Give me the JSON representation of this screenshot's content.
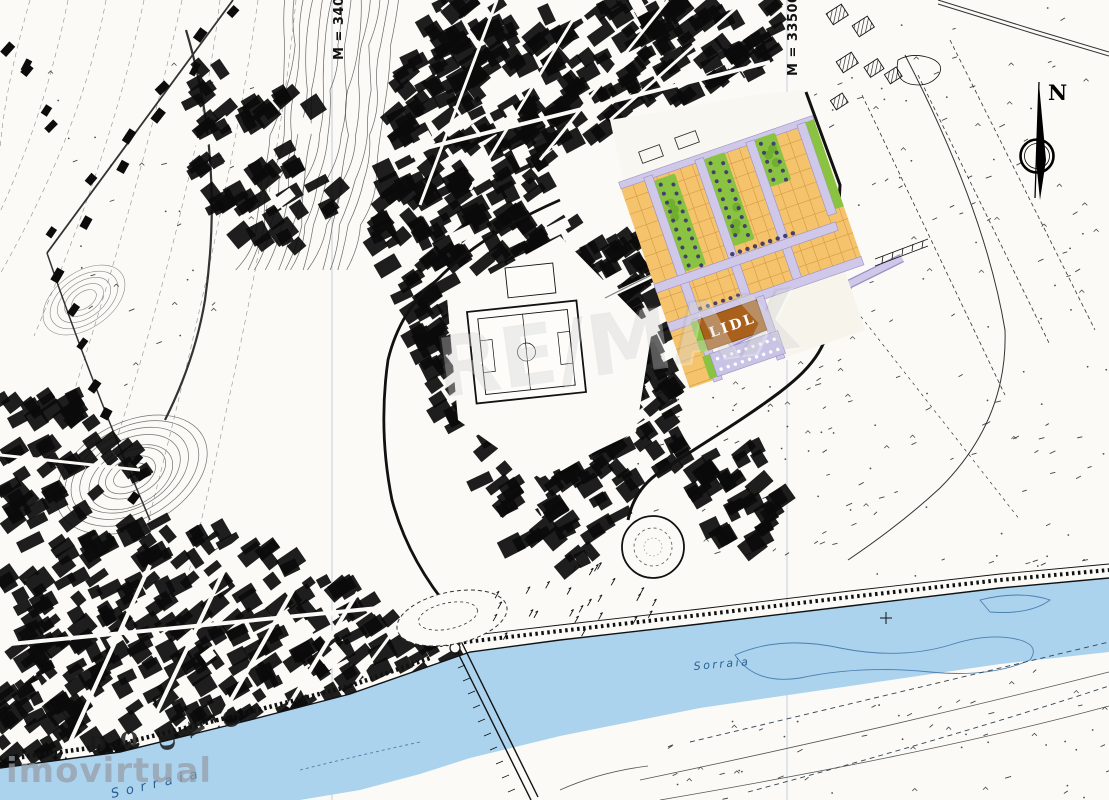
{
  "title": "Urban site plan over scanned topographic map",
  "labels": {
    "lidl": "LIDL",
    "north": "N",
    "grid_right": "M = 33500",
    "grid_left": "M = 34000",
    "river": "Sorraia",
    "river_partial": "Sorraia",
    "bank_letters": [
      "D",
      "O",
      "D",
      "A",
      "O"
    ]
  },
  "watermarks": {
    "center": "RE/MAX",
    "bottom_left": "imovirtual"
  },
  "colors": {
    "paper": "#fbfaf6",
    "ink": "#111111",
    "water": "#abd3ee",
    "water_line": "#4a7fae",
    "lot": "#f4c36c",
    "lot_line": "#d59a45",
    "green": "#8ac341",
    "green_blob": "#6fae2e",
    "tree": "#443f6e",
    "street": "#cfc8e9",
    "street_edge": "#9a90c8",
    "lidl_building": "#a9601b",
    "pale_parcel": "#f7f4ec"
  }
}
